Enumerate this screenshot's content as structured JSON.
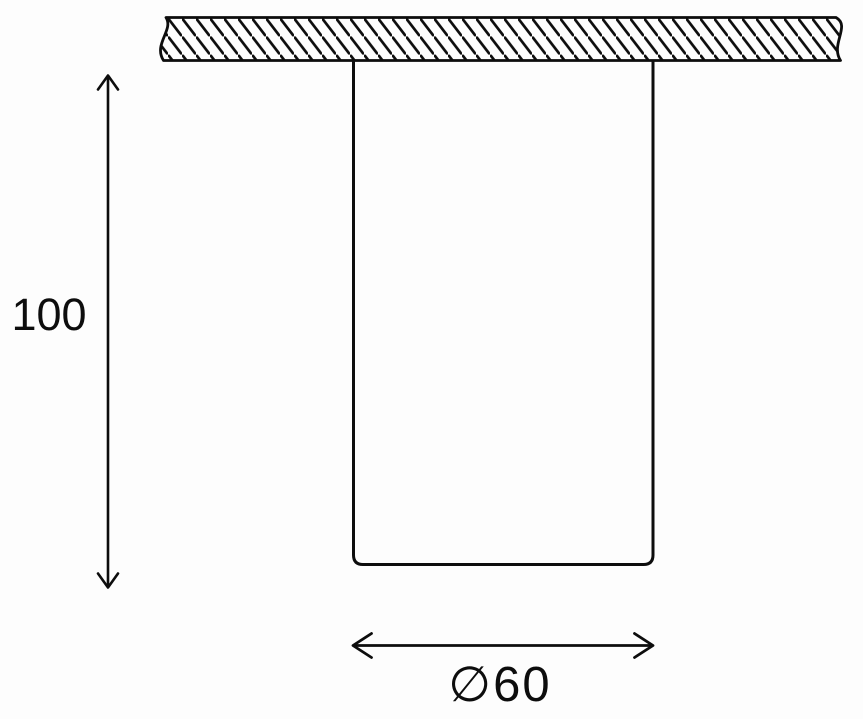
{
  "page": {
    "background_color": "#fdfdfd",
    "line_color": "#0d0d0d"
  },
  "diagram": {
    "type": "technical-dimension-drawing",
    "subject": "surface-mounted cylindrical ceiling light fixture, side elevation",
    "ceiling": {
      "style": "hatched section band with break (wavy) ends"
    },
    "dimensions": {
      "height_label": "100",
      "diameter_label": "∅60"
    }
  }
}
